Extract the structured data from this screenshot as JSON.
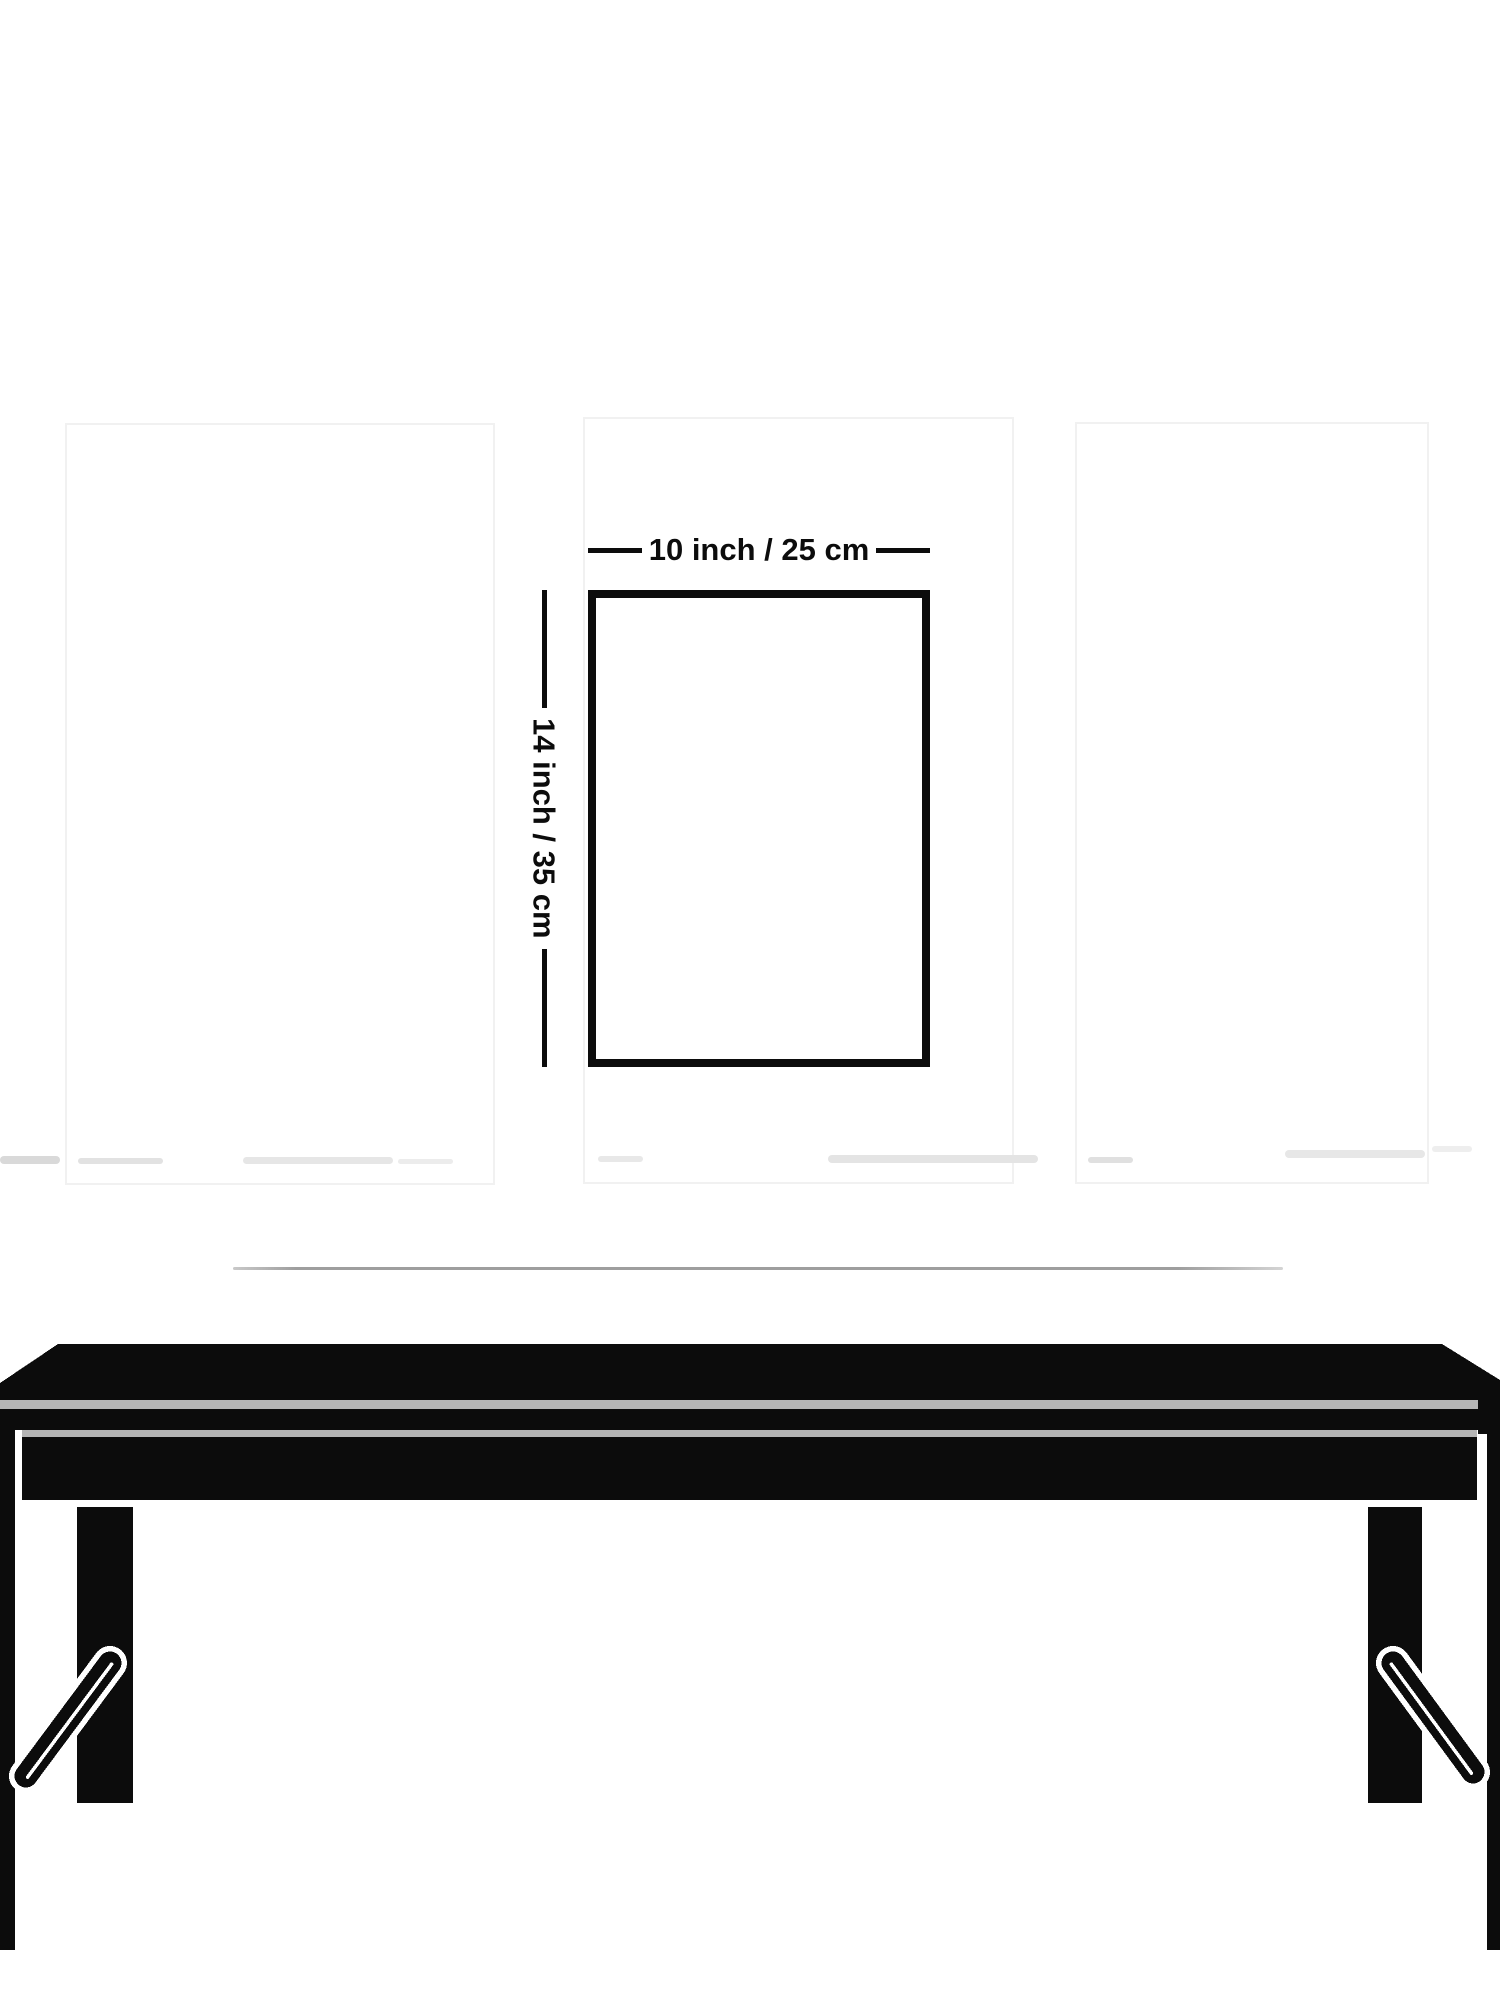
{
  "figure": {
    "width_label": "10 inch / 25 cm",
    "height_label": "14 inch / 35 cm"
  },
  "colors": {
    "ink": "#0c0c0c",
    "divider": "#b5b5b5",
    "faint-line": "#9e9e9e",
    "frame-hint": "#f1f1f1"
  }
}
